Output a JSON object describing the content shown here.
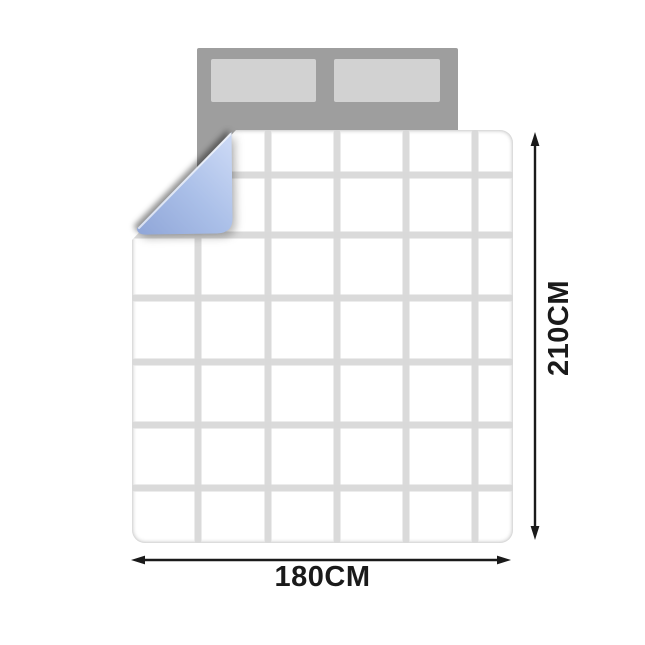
{
  "diagram": {
    "type": "bedding-size-diagram",
    "quilt": {
      "width_label": "180CM",
      "height_label": "210CM",
      "grid_columns": 6,
      "grid_rows": 7
    },
    "colors": {
      "background": "#ffffff",
      "headboard": "#9e9e9e",
      "pillow": "#d2d2d2",
      "quilt_fill": "#ffffff",
      "quilt_line": "#d9d9d9",
      "fold_light": "#c9d7f4",
      "fold_mid": "#aabfe8",
      "fold_dark": "#92a8d9",
      "arrow": "#1a1a1a",
      "label_text": "#1a1a1a"
    }
  }
}
